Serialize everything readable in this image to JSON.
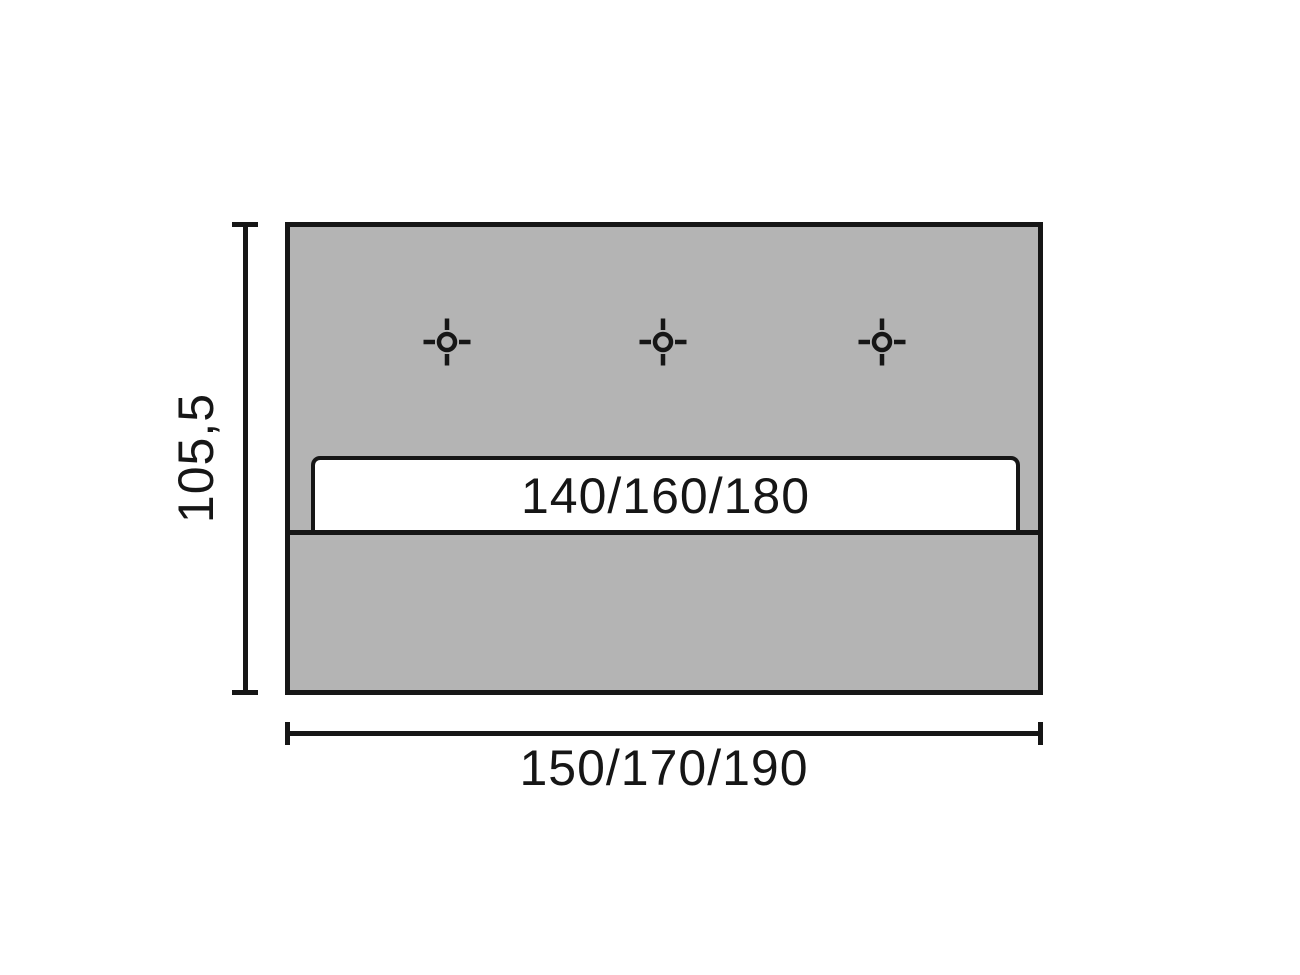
{
  "diagram": {
    "type": "dimension-drawing",
    "labels": {
      "slat_widths": "140/160/180",
      "overall_widths": "150/170/190",
      "overall_height": "105,5"
    },
    "colors": {
      "panel_fill": "#b4b4b4",
      "line": "#161616",
      "slat_fill": "#ffffff",
      "background": "#ffffff"
    },
    "markers": {
      "icon": "crosshair-mount-point",
      "count": 3
    }
  }
}
